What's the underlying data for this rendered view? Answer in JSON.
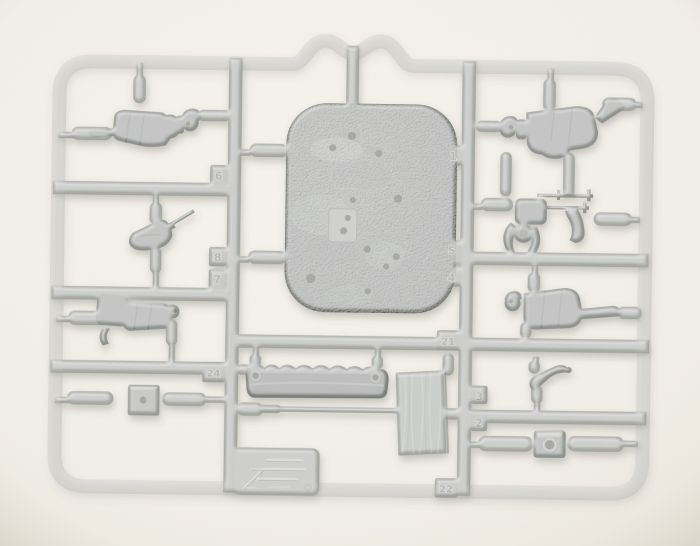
{
  "image": {
    "type": "photograph",
    "subject": "Gray plastic model-kit sprue (injection frame) holding small soldier figures, a machine gun, a textured ground base plate, a sandbag parapet, a wooden plank and small accessory parts, photographed on a light paper background",
    "background_color": "#f3f0e9",
    "sprue_color": "#a6a8a4",
    "part_color": "#8f938f",
    "plate_color": "#9aa09c",
    "sandbag_color": "#7b7f7c",
    "plank_color": "#a2a5a1",
    "hole_color": "#20201e",
    "shadow_color": "#6a665e"
  },
  "tags": [
    {
      "label": "6"
    },
    {
      "label": "8"
    },
    {
      "label": "7"
    },
    {
      "label": "24"
    },
    {
      "label": "1"
    },
    {
      "label": "5"
    },
    {
      "label": "4"
    },
    {
      "label": "21"
    },
    {
      "label": "22"
    },
    {
      "label": "3"
    },
    {
      "label": "2"
    }
  ],
  "logo_plate": {
    "description": "embossed manufacturer logo and marks (illegible)"
  }
}
